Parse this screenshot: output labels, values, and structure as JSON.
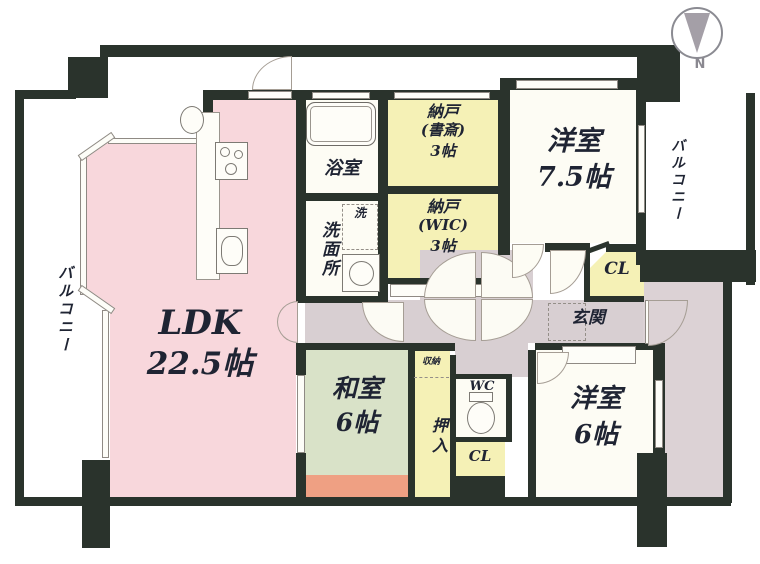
{
  "title_hint": "apartment floor plan",
  "compass": {
    "north_label": "N"
  },
  "balconies": {
    "left": "バルコニー",
    "right": "バルコニー"
  },
  "rooms": {
    "ldk": {
      "name": "LDK",
      "size": "22.5帖"
    },
    "washitsu": {
      "name": "和室",
      "size": "6帖"
    },
    "western75": {
      "name": "洋室",
      "size": "7.5帖"
    },
    "western6": {
      "name": "洋室",
      "size": "6帖"
    },
    "nando_study": {
      "line1": "納戸",
      "line2": "(書斎)",
      "line3": "3帖"
    },
    "nando_wic": {
      "line1": "納戸",
      "line2": "(WIC)",
      "line3": "3帖"
    },
    "bath": {
      "name": "浴室"
    },
    "washroom": {
      "name": "洗面所"
    },
    "washer": {
      "name": "洗"
    },
    "genkan": {
      "name": "玄関"
    },
    "wc": {
      "name": "WC"
    },
    "oshiire": {
      "name": "押入"
    },
    "shuno": {
      "name": "収納"
    },
    "cl_entrance": {
      "name": "CL"
    },
    "cl_south": {
      "name": "CL"
    }
  },
  "colors": {
    "ldk_pink": "#f8d7dc",
    "washitsu_green": "#d9e2c8",
    "engawa_salmon": "#efa083",
    "storage_yellow": "#f5f1b6",
    "corridor_gray": "#d8cfd2",
    "porch_gray": "#dcd2d5",
    "wall_dark": "#2a332c",
    "compass_gray": "#a49fa7"
  }
}
